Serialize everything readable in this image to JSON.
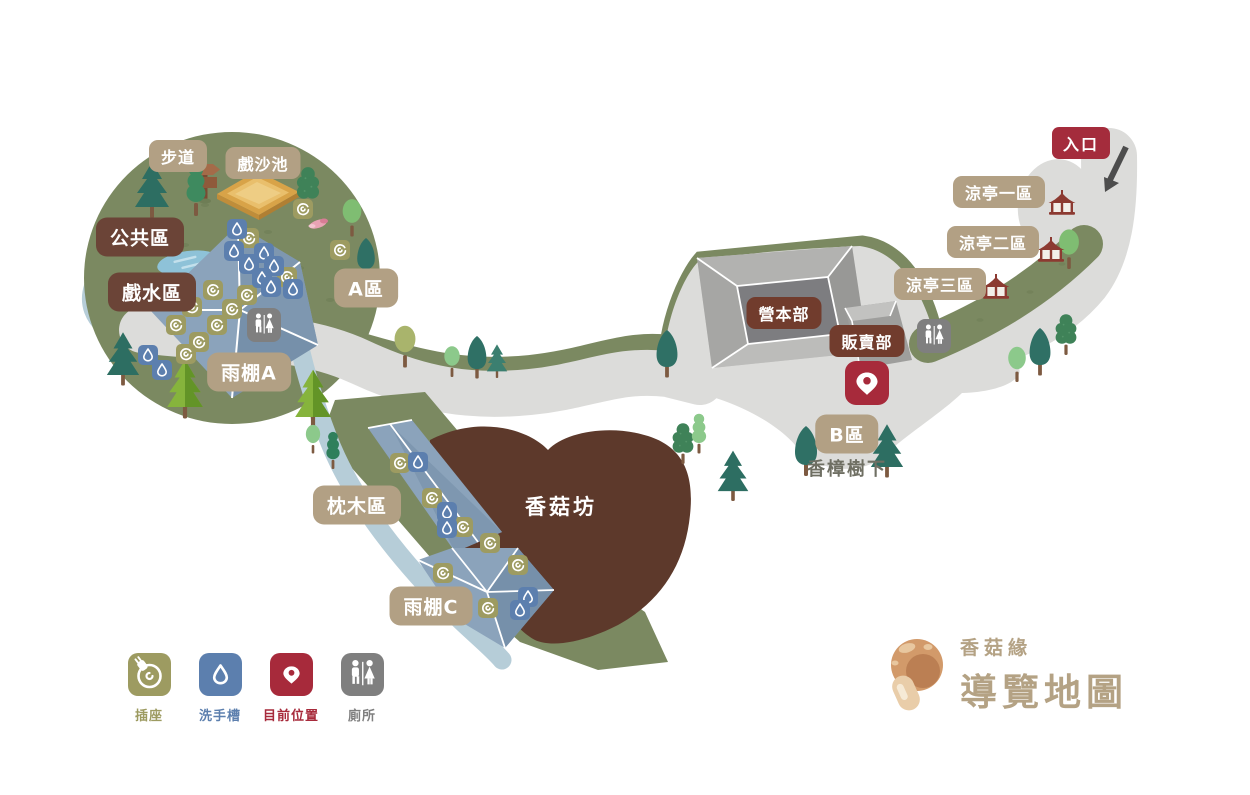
{
  "title": "香菇緣導覽地圖",
  "map_labels": {
    "trail": "步道",
    "sand_pool": "戲沙池",
    "public_area": "公共區",
    "water_play_area": "戲水區",
    "area_a": "A區",
    "shelter_a": "雨棚A",
    "sleeper_area": "枕木區",
    "shelter_c": "雨棚C",
    "mushroom_house": "香菇坊",
    "camp_hq": "營本部",
    "shop": "販賣部",
    "area_b": "B區",
    "under_camphor_tree": "香樟樹下",
    "pavilion_area_1": "涼亭一區",
    "pavilion_area_2": "涼亭二區",
    "pavilion_area_3": "涼亭三區",
    "entrance": "入口"
  },
  "legend": {
    "items": [
      {
        "id": "outlet",
        "label": "插座",
        "color": "#9d9b61"
      },
      {
        "id": "wash_basin",
        "label": "洗手槽",
        "color": "#5c7fae"
      },
      {
        "id": "current_location",
        "label": "目前位置",
        "color": "#a72a3b"
      },
      {
        "id": "toilet",
        "label": "廁所",
        "color": "#7f7f7f"
      }
    ]
  },
  "logo": {
    "brand": "香菇緣",
    "title": "導覽地圖",
    "color": "#b4a284"
  },
  "colors": {
    "grass": "#7b8961",
    "path": "#dcdcda",
    "water": "#b6cdd8",
    "shelter_roof": "#8ba3bb",
    "mushroom_area": "#5d392b",
    "building_gray": "#c7c7c5",
    "label_tan": "#b2a084",
    "label_dark_brown": "#6b4437",
    "label_red_brown": "#713c2d",
    "entrance_red": "#a42c3c"
  }
}
